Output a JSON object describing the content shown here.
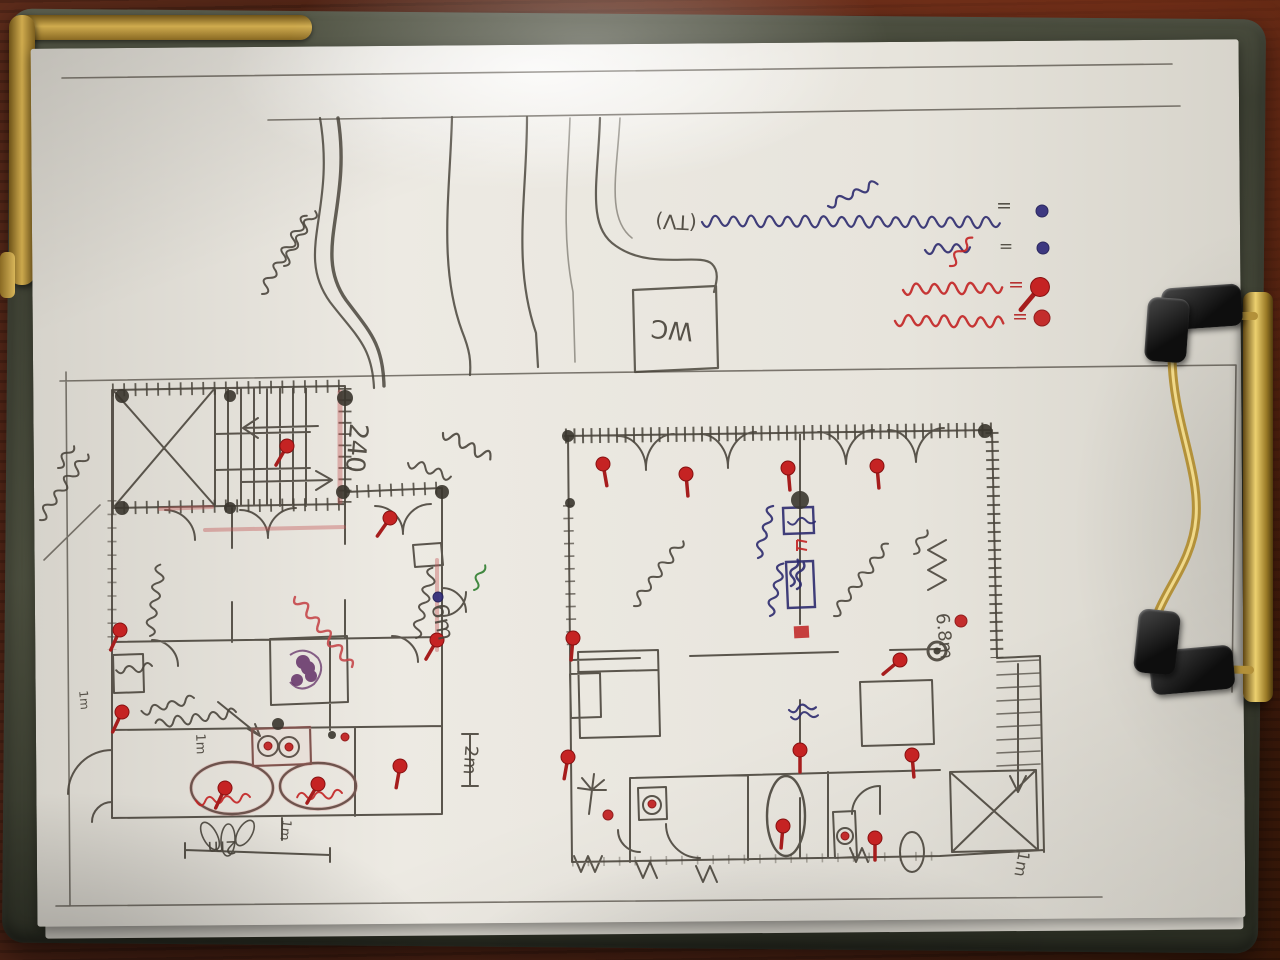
{
  "scene": {
    "subject": "hand-drawn house floor-plan sketch on a clipboard photographed on a dark wooden table",
    "palette": {
      "wood": "#4e2317",
      "board": "#4a4d3d",
      "paper": "#e9e6df",
      "brass": "#cfab4e",
      "pencil": "#4a453c",
      "pen": "#2c2a6e",
      "red": "#c22222",
      "redp": "#c5474a",
      "purple": "#5a2560",
      "green": "#2f7d2f"
    }
  },
  "drawing": {
    "plan_labels": [
      {
        "t": "240",
        "x": 356,
        "y": 448,
        "r": 95,
        "s": 26
      },
      {
        "t": "6m",
        "x": 442,
        "y": 622,
        "r": 78,
        "s": 23
      },
      {
        "t": "2m",
        "x": 470,
        "y": 760,
        "r": 94,
        "s": 18
      },
      {
        "t": "1m",
        "x": 200,
        "y": 744,
        "r": 88,
        "s": 13
      },
      {
        "t": "1m",
        "x": 84,
        "y": 700,
        "r": 85,
        "s": 12
      },
      {
        "t": "2m",
        "x": 222,
        "y": 847,
        "r": 178,
        "s": 18
      },
      {
        "t": "1m",
        "x": 285,
        "y": 830,
        "r": 96,
        "s": 13
      },
      {
        "t": "6.8m",
        "x": 944,
        "y": 636,
        "r": 84,
        "s": 18
      },
      {
        "t": "1m",
        "x": 1022,
        "y": 864,
        "r": 100,
        "s": 16
      },
      {
        "t": "(TV)",
        "x": 676,
        "y": 222,
        "r": 183,
        "s": 20
      },
      {
        "t": "WC",
        "x": 672,
        "y": 330,
        "r": 185,
        "s": 25
      },
      {
        "t": "=",
        "x": 1004,
        "y": 206,
        "r": 180,
        "s": 19
      },
      {
        "t": "=",
        "x": 1006,
        "y": 246,
        "r": 180,
        "s": 17
      },
      {
        "t": "=",
        "x": 1016,
        "y": 285,
        "r": 180,
        "s": 19,
        "c": "red"
      },
      {
        "t": "=",
        "x": 1020,
        "y": 317,
        "r": 180,
        "s": 19,
        "c": "red"
      }
    ],
    "legend": {
      "rows": [
        {
          "marker": "blue-dot",
          "separator": "=",
          "note": "Thai handwriting, dark blue pen, written upside-down"
        },
        {
          "marker": "blue-dot",
          "separator": "=",
          "note": "short Thai word, blue pen, upside-down"
        },
        {
          "marker": "red-pin",
          "separator": "=",
          "note": "Thai handwriting, red pen, upside-down"
        },
        {
          "marker": "red-dot",
          "separator": "=",
          "note": "Thai handwriting, red pen, upside-down"
        }
      ]
    },
    "annotations": [
      {
        "x": 702,
        "y": 222,
        "len": 295,
        "rot": -4,
        "amp": 7,
        "c": "pen",
        "w": 2.2,
        "note": "legend row 1 - Thai handwriting in blue pen (upside-down)"
      },
      {
        "x": 828,
        "y": 206,
        "len": 55,
        "rot": -28,
        "amp": 5,
        "c": "pen",
        "w": 2.2,
        "note": ""
      },
      {
        "x": 925,
        "y": 250,
        "len": 42,
        "rot": -6,
        "amp": 6,
        "c": "pen",
        "w": 2.2,
        "note": "legend row 2 - short Thai word in blue pen"
      },
      {
        "x": 903,
        "y": 290,
        "len": 100,
        "rot": -5,
        "amp": 7,
        "c": "red",
        "w": 2.4,
        "note": "legend row 3 - Thai handwriting in red pen"
      },
      {
        "x": 950,
        "y": 266,
        "len": 32,
        "rot": -55,
        "amp": 5,
        "c": "red",
        "w": 2.2,
        "note": ""
      },
      {
        "x": 895,
        "y": 321,
        "len": 112,
        "rot": -3,
        "amp": 7,
        "c": "red",
        "w": 2.4,
        "note": "legend row 4 - Thai handwriting in red pen"
      },
      {
        "x": 262,
        "y": 294,
        "len": 92,
        "rot": -64,
        "amp": 6,
        "c": "pencil",
        "w": 2,
        "note": "pencil note with number near driveway (rotated)"
      },
      {
        "x": 284,
        "y": 266,
        "len": 65,
        "rot": -64,
        "amp": 5,
        "c": "pencil",
        "w": 2,
        "note": ""
      },
      {
        "x": 40,
        "y": 520,
        "len": 82,
        "rot": -58,
        "amp": 6,
        "c": "pencil",
        "w": 2,
        "note": "pencil note on left margin (rotated)"
      },
      {
        "x": 58,
        "y": 468,
        "len": 30,
        "rot": -58,
        "amp": 5,
        "c": "pencil",
        "w": 2,
        "note": ""
      },
      {
        "x": 150,
        "y": 636,
        "len": 74,
        "rot": -85,
        "amp": 6,
        "c": "pencil",
        "w": 2,
        "note": "room label, Thai (rotated vertical)"
      },
      {
        "x": 416,
        "y": 638,
        "len": 70,
        "rot": -80,
        "amp": 6,
        "c": "pencil",
        "w": 2,
        "note": "room label, Thai (rotated vertical)"
      },
      {
        "x": 295,
        "y": 597,
        "len": 88,
        "rot": 47,
        "amp": 6,
        "c": "redp",
        "w": 2.4,
        "note": "red-pencil note along inner wall (diagonal)"
      },
      {
        "x": 236,
        "y": 712,
        "len": 82,
        "rot": 168,
        "amp": 6,
        "c": "pencil",
        "w": 2,
        "note": "furniture label, Thai (upside-down) with arrow to basins"
      },
      {
        "x": 194,
        "y": 698,
        "len": 58,
        "rot": 162,
        "amp": 5,
        "c": "pencil",
        "w": 2,
        "note": ""
      },
      {
        "x": 152,
        "y": 666,
        "len": 40,
        "rot": 170,
        "amp": 5,
        "c": "pencil",
        "w": 2,
        "note": ""
      },
      {
        "x": 250,
        "y": 797,
        "len": 52,
        "rot": 172,
        "amp": 5,
        "c": "red",
        "w": 2,
        "note": "red label inside left oval tub"
      },
      {
        "x": 342,
        "y": 793,
        "len": 46,
        "rot": 172,
        "amp": 5,
        "c": "red",
        "w": 2,
        "note": "red label inside right oval tub"
      },
      {
        "x": 634,
        "y": 606,
        "len": 82,
        "rot": -57,
        "amp": 6,
        "c": "pencil",
        "w": 2,
        "note": "room label, Thai (diagonal)"
      },
      {
        "x": 834,
        "y": 616,
        "len": 92,
        "rot": -57,
        "amp": 6,
        "c": "pencil",
        "w": 2,
        "note": "room label, Thai (diagonal)"
      },
      {
        "x": 758,
        "y": 558,
        "len": 54,
        "rot": -78,
        "amp": 5,
        "c": "pen",
        "w": 2.2,
        "note": "blue pen note at wall panel"
      },
      {
        "x": 770,
        "y": 616,
        "len": 58,
        "rot": -80,
        "amp": 5,
        "c": "pen",
        "w": 2.2,
        "note": "blue pen note at wall panel"
      },
      {
        "x": 914,
        "y": 554,
        "len": 28,
        "rot": -65,
        "amp": 5,
        "c": "pencil",
        "w": 2,
        "note": ""
      },
      {
        "x": 443,
        "y": 433,
        "len": 52,
        "rot": 25,
        "amp": 7,
        "c": "pencil",
        "w": 2.2,
        "note": "pencil flourish near courtyard"
      },
      {
        "x": 408,
        "y": 463,
        "len": 44,
        "rot": 15,
        "amp": 6,
        "c": "pencil",
        "w": 2,
        "note": ""
      },
      {
        "x": 474,
        "y": 590,
        "len": 22,
        "rot": -70,
        "amp": 4,
        "c": "green",
        "w": 2,
        "note": "small green ink mark"
      },
      {
        "x": 788,
        "y": 522,
        "len": 20,
        "rot": -5,
        "amp": 4,
        "c": "pen",
        "w": 2,
        "note": ""
      },
      {
        "x": 791,
        "y": 586,
        "len": 18,
        "rot": -80,
        "amp": 4,
        "c": "pen",
        "w": 2.4,
        "note": ""
      },
      {
        "x": 797,
        "y": 589,
        "len": 18,
        "rot": -80,
        "amp": 4,
        "c": "pen",
        "w": 2.4,
        "note": ""
      },
      {
        "x": 789,
        "y": 710,
        "len": 22,
        "rot": -10,
        "amp": 4,
        "c": "pen",
        "w": 2.2,
        "note": "small blue mark mid-plan"
      },
      {
        "x": 791,
        "y": 717,
        "len": 18,
        "rot": -8,
        "amp": 4,
        "c": "pen",
        "w": 2,
        "note": ""
      }
    ],
    "red_pins": [
      [
        287,
        446,
        120
      ],
      [
        390,
        518,
        125
      ],
      [
        120,
        630,
        115
      ],
      [
        437,
        640,
        120
      ],
      [
        225,
        788,
        115
      ],
      [
        318,
        784,
        120
      ],
      [
        400,
        766,
        100
      ],
      [
        122,
        712,
        115
      ],
      [
        603,
        464,
        80
      ],
      [
        686,
        474,
        85
      ],
      [
        788,
        468,
        85
      ],
      [
        877,
        466,
        85
      ],
      [
        900,
        660,
        140
      ],
      [
        573,
        638,
        95
      ],
      [
        800,
        750,
        90
      ],
      [
        912,
        755,
        85
      ],
      [
        783,
        826,
        95
      ],
      [
        875,
        838,
        90
      ],
      [
        568,
        757,
        100
      ],
      [
        1040,
        287,
        130,
        1.35
      ]
    ],
    "red_dots": [
      [
        268,
        746,
        4
      ],
      [
        289,
        747,
        4
      ],
      [
        345,
        737,
        4
      ],
      [
        608,
        815,
        5
      ],
      [
        652,
        804,
        4
      ],
      [
        845,
        836,
        4
      ],
      [
        961,
        621,
        6
      ],
      [
        1042,
        318,
        8
      ]
    ],
    "blue_dots": [
      [
        1042,
        211,
        6
      ],
      [
        1043,
        248,
        6
      ],
      [
        438,
        597,
        5
      ]
    ]
  }
}
